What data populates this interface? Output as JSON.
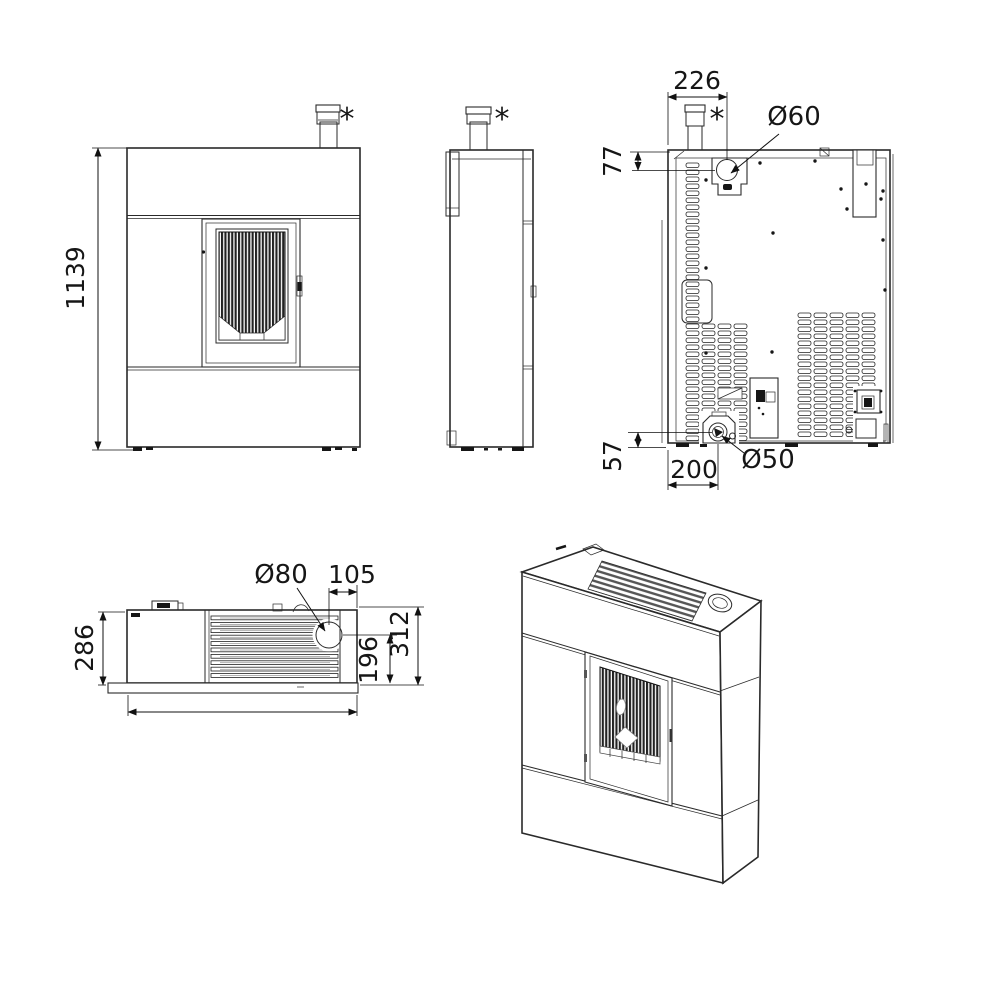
{
  "labels": {
    "front_height": "1139",
    "front_chimney_note": "*",
    "side_chimney_note": "*",
    "rear_chimney_note": "*",
    "rear_width_to_air_intake": "226",
    "rear_top_to_air_intake": "77",
    "rear_air_intake_diameter": "Ø60",
    "rear_bottom_to_flue": "57",
    "rear_left_to_flue": "200",
    "rear_flue_diameter": "Ø50",
    "top_depth": "286",
    "top_outlet_diameter": "Ø80",
    "top_outlet_to_side": "105",
    "top_outlet_to_front": "196",
    "top_total_depth": "312"
  },
  "colors": {
    "line": "#2a2a2a",
    "dimension": "#111111",
    "background": "#ffffff"
  }
}
